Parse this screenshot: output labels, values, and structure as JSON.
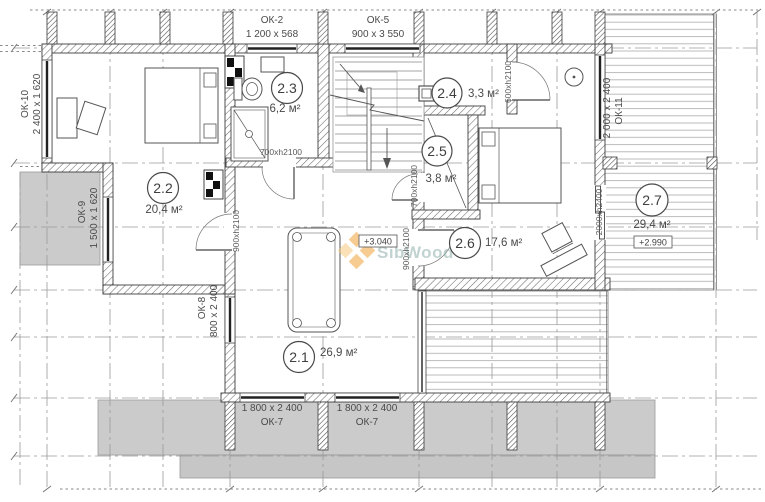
{
  "plan": {
    "watermark": "SibWood",
    "windows": {
      "ok2": {
        "name": "ОК-2",
        "size": "1 200 x 568"
      },
      "ok5": {
        "name": "ОК-5",
        "size": "900 x 3 550"
      },
      "ok7a": {
        "name": "ОК-7",
        "size": "1 800 x 2 400"
      },
      "ok7b": {
        "name": "ОК-7",
        "size": "1 800 x 2 400"
      },
      "ok8": {
        "name": "ОК-8",
        "size": "800 x 2 400"
      },
      "ok9": {
        "name": "ОК-9",
        "size": "1 500 x 1 620"
      },
      "ok10": {
        "name": "ОК-10",
        "size": "2 400 x 1 620"
      },
      "ok11": {
        "name": "ОК-11",
        "size": "2 000 x 2 400"
      }
    },
    "rooms": {
      "r21": {
        "number": "2.1",
        "area": "26,9 м²"
      },
      "r22": {
        "number": "2.2",
        "area": "20,4 м²"
      },
      "r23": {
        "number": "2.3",
        "area": "6,2 м²"
      },
      "r24": {
        "number": "2.4",
        "area": "3,3 м²"
      },
      "r25": {
        "number": "2.5",
        "area": "3,8 м²"
      },
      "r26": {
        "number": "2.6",
        "area": "17,6 м²"
      },
      "r27": {
        "number": "2.7",
        "area": "29,4 м²"
      }
    },
    "doors": {
      "bathroom": "700xh2100",
      "room22": "900xh2100",
      "closet": "700xh2100",
      "room26": "900xh2100",
      "room24": "600xh2100",
      "terrace": "2000xh2400"
    },
    "elevations": {
      "hall": "+3.040",
      "terrace": "+2.990"
    },
    "colors": {
      "accent_orange": "#f0a43c",
      "accent_orange_light": "#f7c97e",
      "watermark_text": "#8fb0ad"
    }
  }
}
